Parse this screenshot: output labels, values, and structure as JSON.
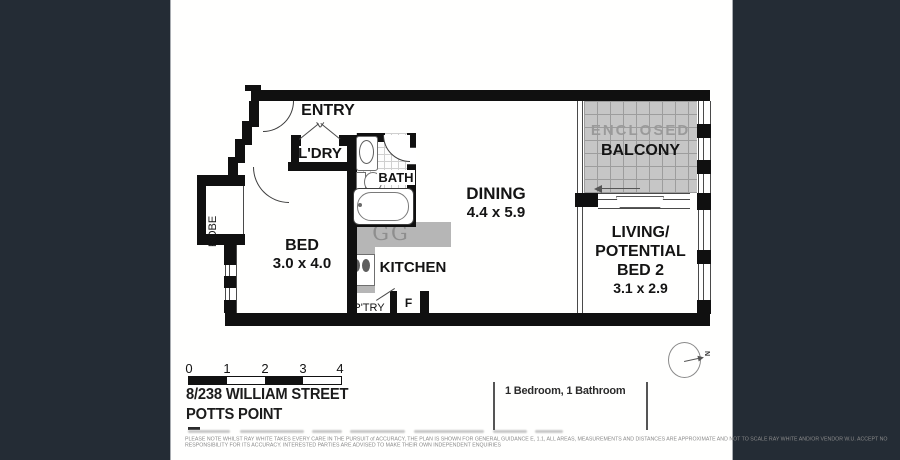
{
  "colors": {
    "background": "#242c35",
    "paper": "#ffffff",
    "wall": "#101010",
    "counter": "#b6b6b6",
    "balcony_floor": "#c6c6c6",
    "muted_text": "#9a9a9a"
  },
  "plan": {
    "rooms": {
      "entry": {
        "label": "ENTRY"
      },
      "laundry": {
        "label": "L'DRY"
      },
      "bath": {
        "label": "BATH"
      },
      "dining": {
        "label": "DINING",
        "dims": "4.4 x 5.9"
      },
      "balcony": {
        "label_line1": "ENCLOSED",
        "label_line2": "BALCONY"
      },
      "living": {
        "label_line1": "LIVING/",
        "label_line2": "POTENTIAL",
        "label_line3": "BED 2",
        "dims": "3.1 x 2.9"
      },
      "bed": {
        "label": "BED",
        "dims": "3.0 x 4.0"
      },
      "kitchen": {
        "label": "KITCHEN"
      },
      "robe": {
        "label": "ROBE"
      },
      "pantry": {
        "label": "P'TRY"
      },
      "fridge": {
        "label": "F"
      },
      "cooktop": {
        "label": "GG"
      }
    }
  },
  "scale_bar": {
    "ticks": [
      "0",
      "1",
      "2",
      "3",
      "4"
    ]
  },
  "address": {
    "line1": "8/238 WILLIAM STREET",
    "line2": "POTTS POINT"
  },
  "summary": {
    "text": "1 Bedroom, 1 Bathroom"
  },
  "compass": {
    "label": "N"
  },
  "disclaimer": {
    "line1": "PLEASE NOTE WHILST RAY WHITE TAKES EVERY CARE IN THE PURSUIT of ACCURACY, THE PLAN IS SHOWN FOR GENERAL GUIDANCE E, 1.1, ALL AREAS, MEASUREMENTS AND DISTANCES ARE APPROXIMATE AND NOT TO SCALE RAY WHITE AND/OR VENDOR W.U. ACCEPT NO",
    "line2": "RESPONSIBILITY FOR ITS ACCURACY. INTERESTED PARTIES ARE ADVISED TO MAKE THEIR OWN INDEPENDENT ENQUIRIES"
  }
}
